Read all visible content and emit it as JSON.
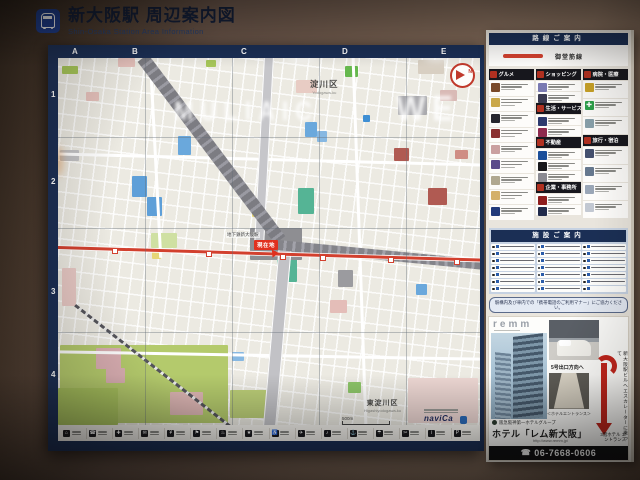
{
  "wall_sign": {
    "title": "新大阪駅 周辺案内図",
    "subtitle": "Shin-Osaka Station Area Information"
  },
  "map_board": {
    "grid": {
      "columns": [
        {
          "label": "A",
          "x": 14
        },
        {
          "label": "B",
          "x": 74
        },
        {
          "label": "C",
          "x": 183
        },
        {
          "label": "D",
          "x": 284
        },
        {
          "label": "E",
          "x": 383
        }
      ],
      "rows": [
        {
          "label": "1",
          "y": 32
        },
        {
          "label": "2",
          "y": 119
        },
        {
          "label": "3",
          "y": 229
        },
        {
          "label": "4",
          "y": 312
        }
      ]
    },
    "labels": {
      "ward_top_ja": "淀川区",
      "ward_top_en": "Yodogawa-ku",
      "ward_bottom_ja": "東淀川区",
      "ward_bottom_en": "Higashiyodogawa-ku",
      "station": "地下鉄新大阪駅",
      "current_location": "現在地",
      "compass": "N",
      "scale": "500m",
      "credit": "naviCa"
    },
    "line_color": "#d2402e",
    "stations": [
      [
        54,
        190
      ],
      [
        148,
        193
      ],
      [
        222,
        196
      ],
      [
        262,
        197
      ],
      [
        330,
        199
      ],
      [
        396,
        201
      ]
    ],
    "reflection": [
      {
        "text": "MULIAIC",
        "x": 116,
        "y": 40,
        "size": 23
      },
      {
        "text": "WE",
        "x": 338,
        "y": 33,
        "size": 31
      }
    ],
    "art": [
      [
        2,
        287,
        168,
        78,
        "#b4ca6c"
      ],
      [
        0,
        330,
        60,
        37,
        "#a8c25e"
      ],
      [
        172,
        332,
        40,
        28,
        "#bccf78"
      ],
      [
        287,
        8,
        13,
        11,
        "#66b84e"
      ],
      [
        240,
        130,
        16,
        26,
        "#55b495"
      ],
      [
        219,
        196,
        20,
        28,
        "#55b495"
      ],
      [
        290,
        324,
        13,
        11,
        "#8cc468"
      ],
      [
        4,
        8,
        16,
        8,
        "#a6c659"
      ],
      [
        148,
        2,
        10,
        7,
        "#a6c659"
      ],
      [
        93,
        175,
        26,
        15,
        "#cfe0a2"
      ],
      [
        74,
        118,
        15,
        21,
        "#5e9fd8"
      ],
      [
        89,
        139,
        15,
        19,
        "#5e9fd8"
      ],
      [
        120,
        78,
        13,
        19,
        "#6aa8dc"
      ],
      [
        247,
        64,
        12,
        15,
        "#6aa8dc"
      ],
      [
        259,
        73,
        10,
        11,
        "#87b8e2"
      ],
      [
        174,
        294,
        12,
        9,
        "#87b8e2"
      ],
      [
        358,
        226,
        11,
        11,
        "#6aa8dc"
      ],
      [
        305,
        57,
        7,
        7,
        "#3f8fd4"
      ],
      [
        60,
        0,
        17,
        9,
        "#e6c2bc"
      ],
      [
        28,
        34,
        13,
        9,
        "#e6c2bc"
      ],
      [
        238,
        22,
        21,
        13,
        "#e8ccc4"
      ],
      [
        336,
        90,
        15,
        13,
        "#b05a52"
      ],
      [
        370,
        130,
        19,
        17,
        "#b05a52"
      ],
      [
        397,
        92,
        13,
        9,
        "#cf8d84"
      ],
      [
        38,
        290,
        25,
        21,
        "#d9aeb2"
      ],
      [
        48,
        310,
        19,
        15,
        "#d9aeb2"
      ],
      [
        112,
        334,
        33,
        23,
        "#ddb6b4"
      ],
      [
        350,
        320,
        70,
        45,
        "#ecd6d2"
      ],
      [
        382,
        32,
        17,
        11,
        "#d9bab6"
      ],
      [
        4,
        210,
        14,
        38,
        "#e8c9c5"
      ],
      [
        272,
        242,
        17,
        13,
        "#e4bdb8"
      ],
      [
        192,
        170,
        52,
        32,
        "#8e8e92"
      ],
      [
        340,
        38,
        29,
        19,
        "#a9a9ad"
      ],
      [
        280,
        212,
        15,
        17,
        "#9b9b9f"
      ],
      [
        2,
        92,
        19,
        11,
        "#c2c2c4"
      ],
      [
        194,
        150,
        12,
        9,
        "#e6d678"
      ],
      [
        94,
        194,
        9,
        7,
        "#e6d678"
      ],
      [
        360,
        2,
        26,
        14,
        "#d8cfc2"
      ]
    ],
    "legend_glyphs": [
      "⌂",
      "☎",
      "✚",
      "✉",
      "¥",
      "⚑",
      "♨",
      "★",
      "♿",
      "✈",
      "♪",
      "⚓",
      "☂",
      "✂",
      "i",
      "P"
    ]
  },
  "side_panel": {
    "route": {
      "header": "路線ご案内",
      "line_name": "御堂筋線"
    },
    "ad_columns": [
      {
        "tile_h": 14.5,
        "segments": [
          {
            "header": "グルメ"
          },
          {
            "count": 9,
            "accents": [
              "#7a4a2a",
              "#caa84a",
              "#26262e",
              "#8a3030",
              "#caa0a0",
              "#5a4a8a",
              "#b0a890",
              "#d4b06a",
              "#223a7a"
            ]
          }
        ]
      },
      {
        "tile_h": 10,
        "segments": [
          {
            "header": "ショッピング"
          },
          {
            "count": 2,
            "accents": [
              "#7a7ab2",
              "#3a3a52"
            ]
          },
          {
            "header": "生活・サービス"
          },
          {
            "count": 2,
            "accents": [
              "#2c3a6e",
              "#8e2a4e"
            ]
          },
          {
            "header": "不動産"
          },
          {
            "count": 3,
            "accents": [
              "#1b4f9a",
              "#17171b",
              "#8a8a92"
            ]
          },
          {
            "header": "企業・事務所"
          },
          {
            "count": 2,
            "accents": [
              "#8e1d1d",
              "#202a4a"
            ]
          }
        ]
      },
      {
        "tile_h": 17,
        "segments": [
          {
            "header": "病院・医療"
          },
          {
            "count": 3,
            "accents": [
              "#c9a227",
              "#2da04a",
              "#88a0aa"
            ],
            "glyphs": [
              "",
              "✚",
              ""
            ]
          },
          {
            "header": "旅行・宿泊"
          },
          {
            "count": 4,
            "accents": [
              "#44506e",
              "#66788e",
              "#9aa6b6",
              "#c2c8d2"
            ]
          }
        ]
      }
    ],
    "facility": {
      "header": "施設ご案内",
      "count": 21
    },
    "notice": "駅構内及び車内での「携帯電話のご利用マナー」にご協力ください。",
    "hotel": {
      "brand": "remm",
      "group": "阪急阪神第一ホテルグループ",
      "name": "ホテル「レム新大阪」",
      "url": "http://www.remm.jp/",
      "phone": "06-7668-0606",
      "phone_icon": "☎",
      "exit_note": "5号出口方向へ",
      "entrance_caption": "＜ホテルエントランス＞",
      "side_note": "新大阪駅ビルへエスカレーターに乗って",
      "floor_note": "3階ホテル エントランス"
    }
  }
}
